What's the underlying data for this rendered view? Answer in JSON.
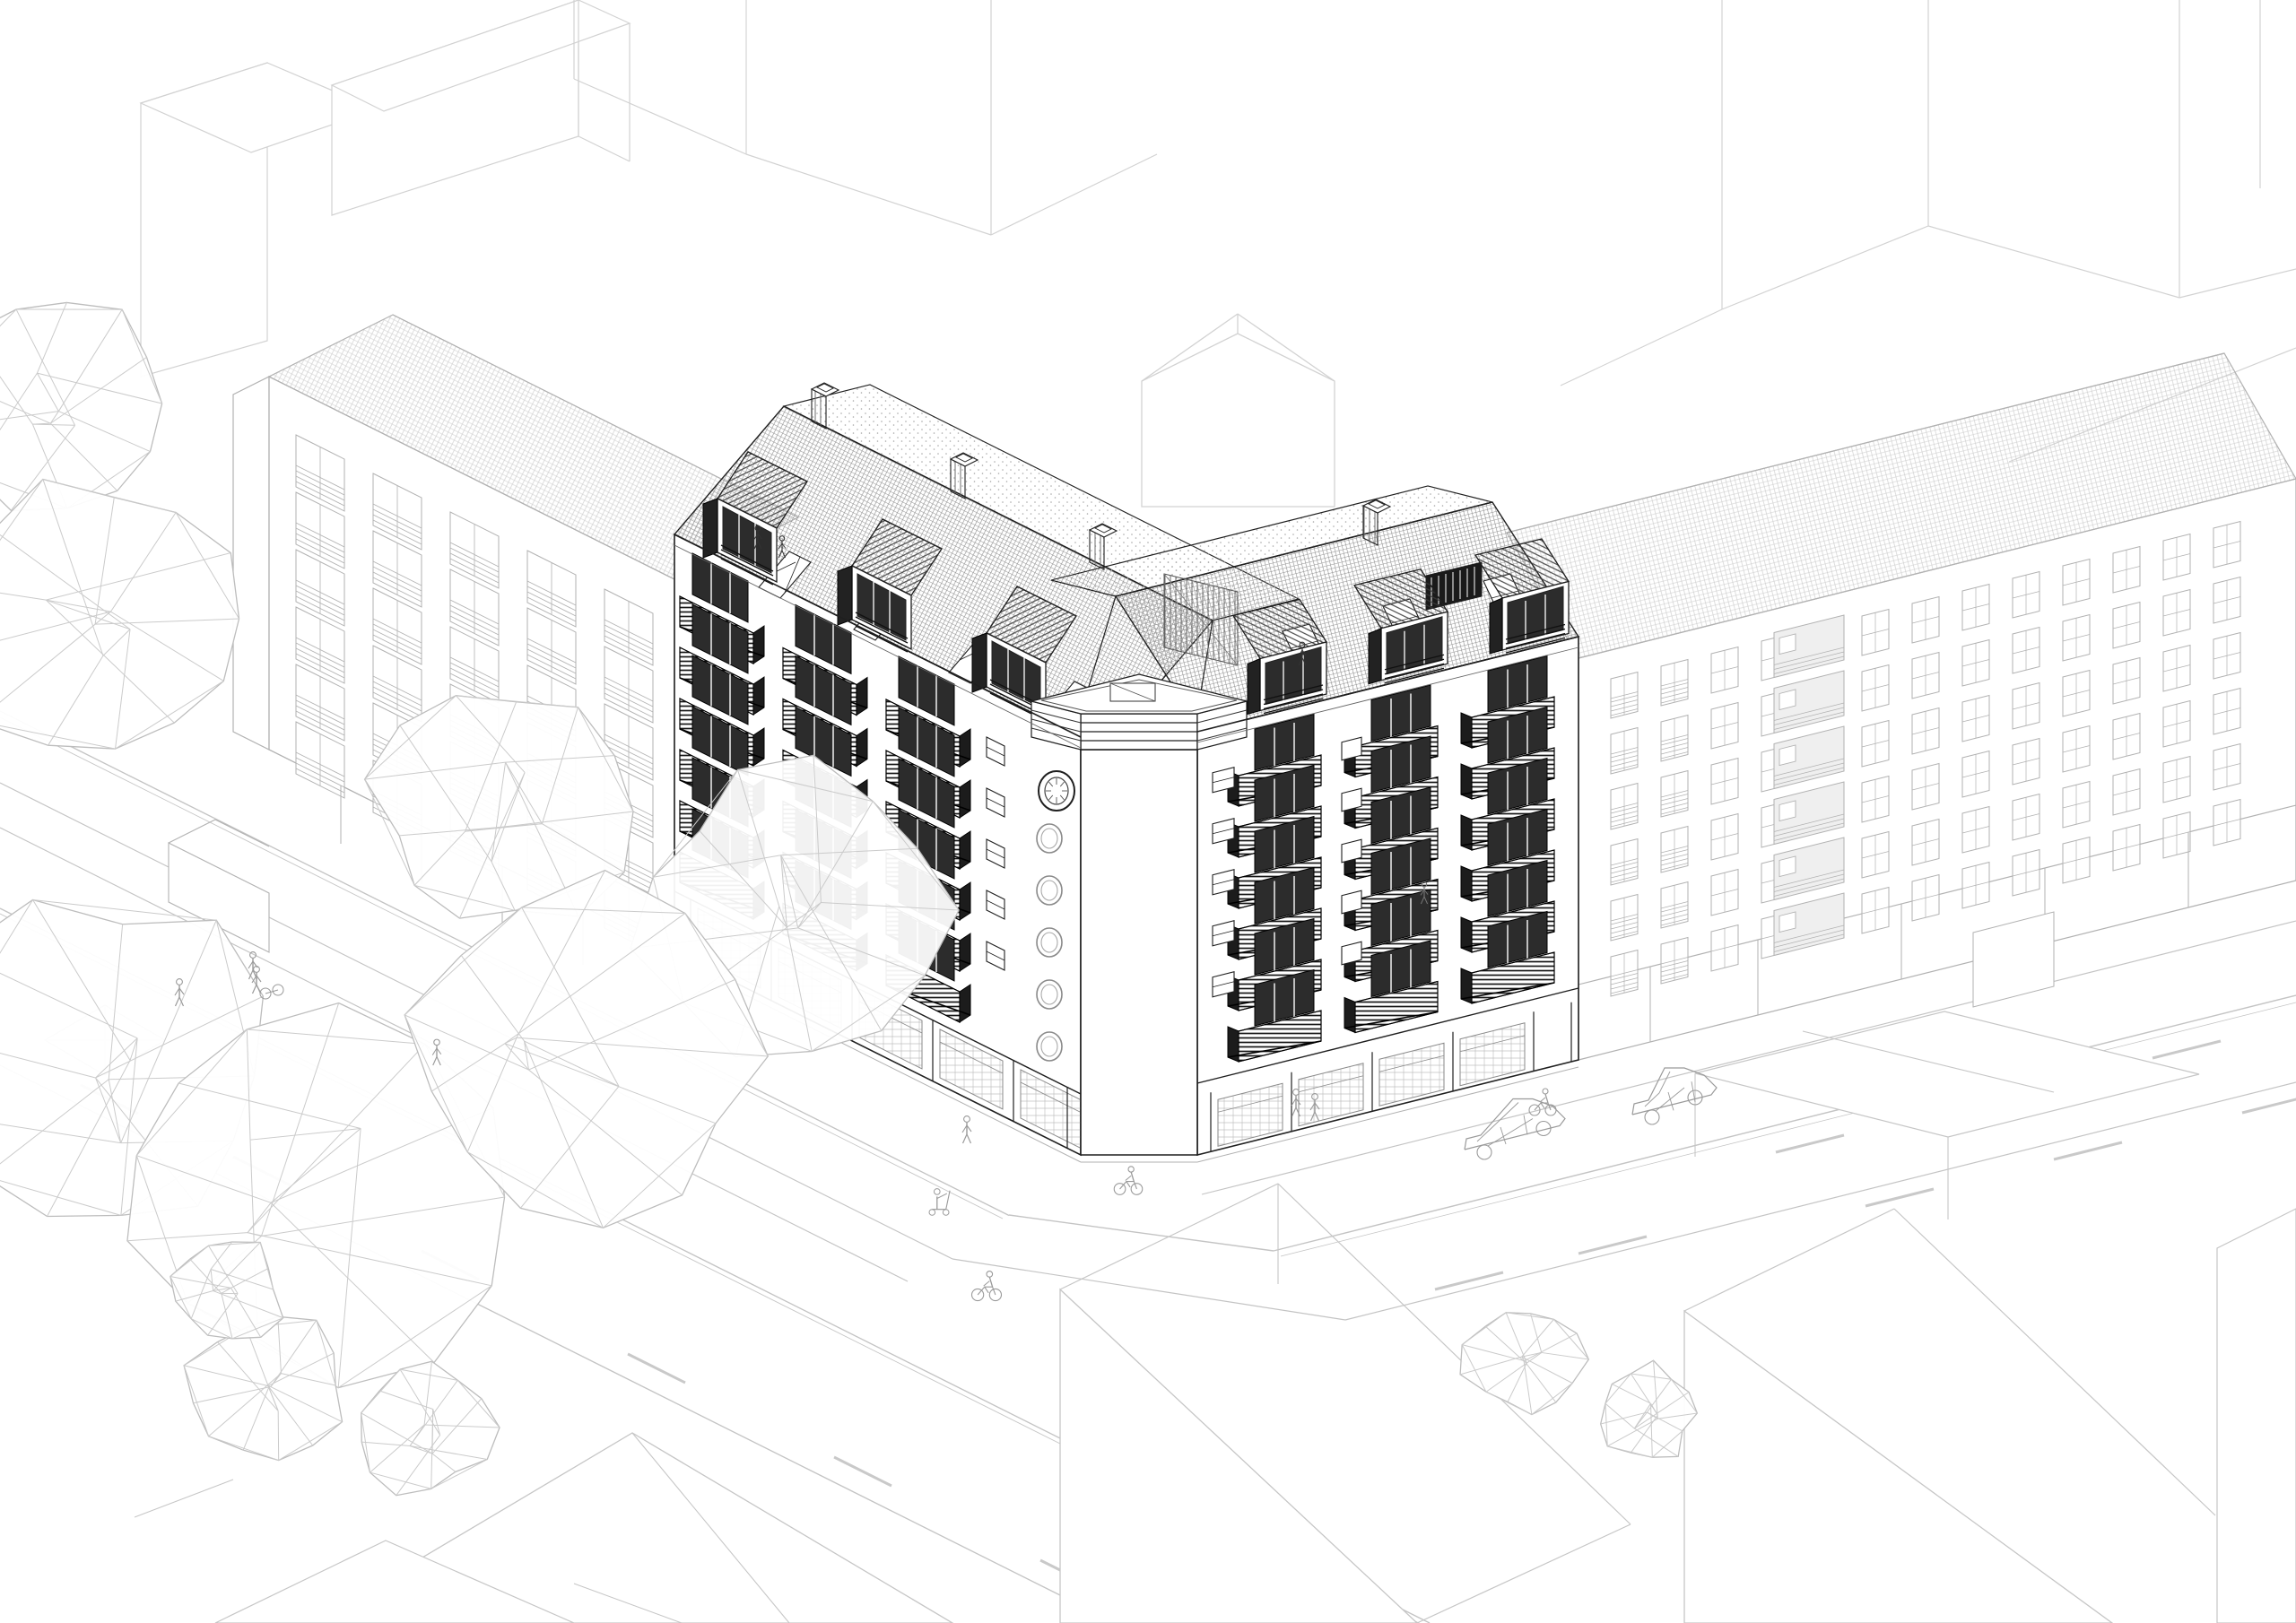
{
  "drawing": {
    "kind": "axonometric architectural line drawing",
    "subject": "corner apartment block with balcony facades, dormers and a corner clock tower"
  },
  "palette": {
    "background": "#ffffff",
    "ink": "#1f1f1f",
    "detail": "#555555",
    "glazing": "#2c2c2c",
    "stripe": "#3a3a3a",
    "context": "#b2b2b2",
    "faint": "#d2d2d2",
    "foreground": "#c6c6c6",
    "road": "#c4c4c4",
    "figure": "#9a9a9a",
    "tree": "#bdbdbd",
    "roof_hatch": "#909090",
    "roof_hatch_light": "#c9c9c9"
  },
  "inventory": {
    "corner_tower": {
      "clock": 1,
      "porthole_windows": 5,
      "roof_terrace": 1
    },
    "dormers_with_striped_hoods": 6,
    "balcony_stacks": 6,
    "balconies_per_stack": 6,
    "roof_skylights": 7,
    "chimneys": 4,
    "context_buildings": 2,
    "background_blocks": 6,
    "foreground_blocks": 5,
    "trees": 8,
    "bushes": 5,
    "pedestrians": 7,
    "cyclists": 3,
    "scooter_riders": 1,
    "cars": 2,
    "crosswalk_diamond": 1
  }
}
